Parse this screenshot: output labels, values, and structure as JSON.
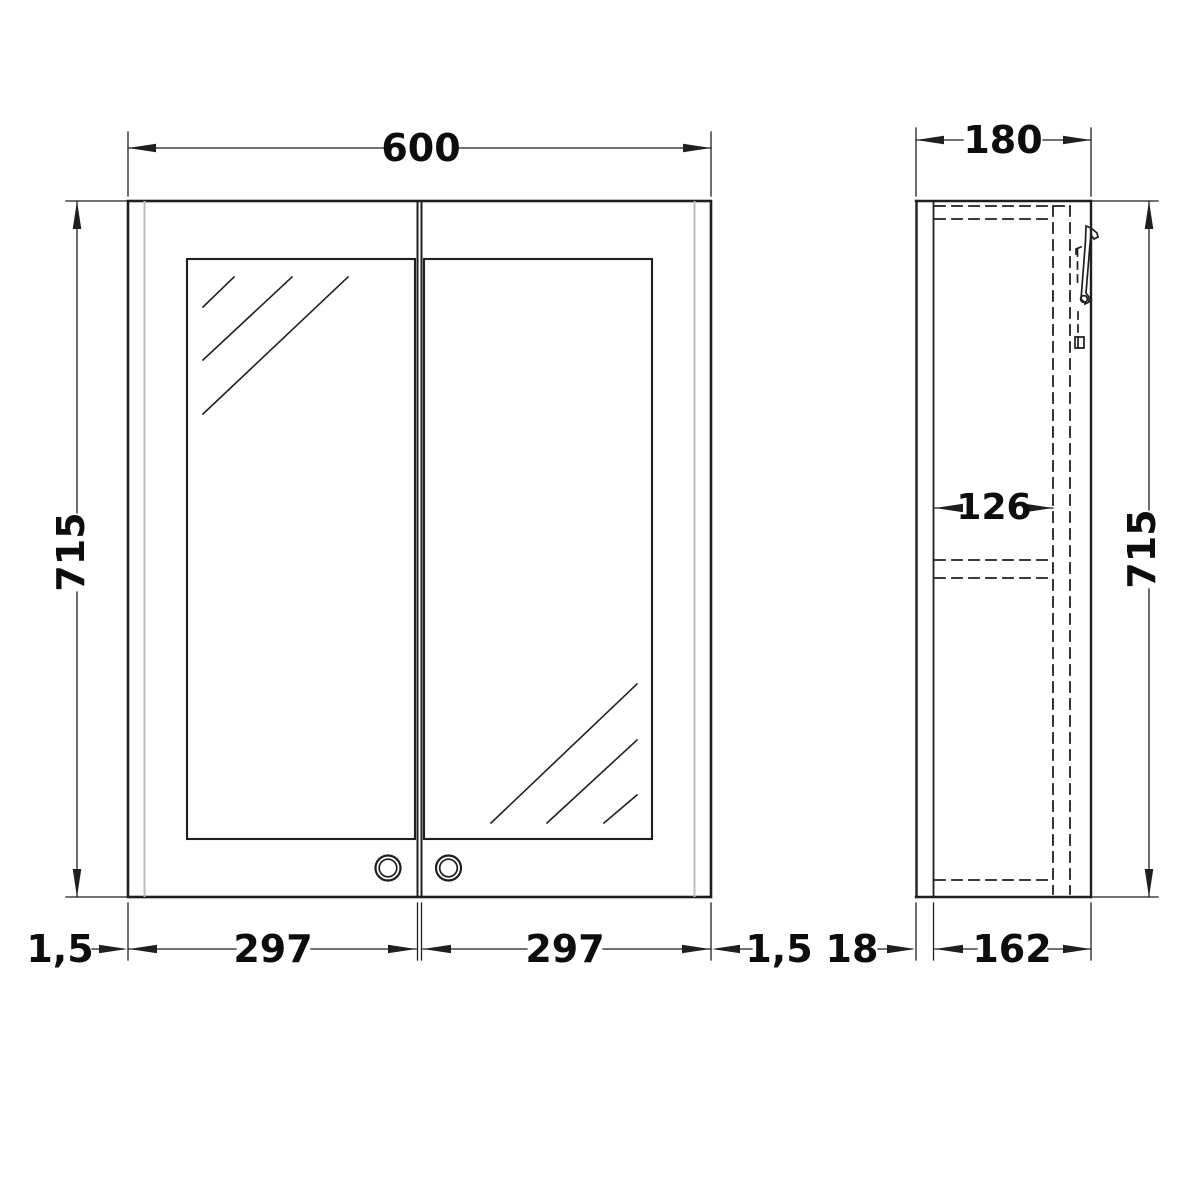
{
  "drawing": {
    "front_view": {
      "overall_width": "600",
      "overall_height": "715",
      "left_edge_gap": "1,5",
      "left_door_width": "297",
      "right_door_width": "297",
      "right_edge_gap": "1,5"
    },
    "side_view": {
      "overall_depth": "180",
      "overall_height": "715",
      "internal_depth": "126",
      "door_thickness": "18",
      "carcass_depth": "162"
    },
    "colors": {
      "line": "#1f1f1f",
      "light_edge": "#bcbcbc",
      "background": "#ffffff"
    }
  }
}
